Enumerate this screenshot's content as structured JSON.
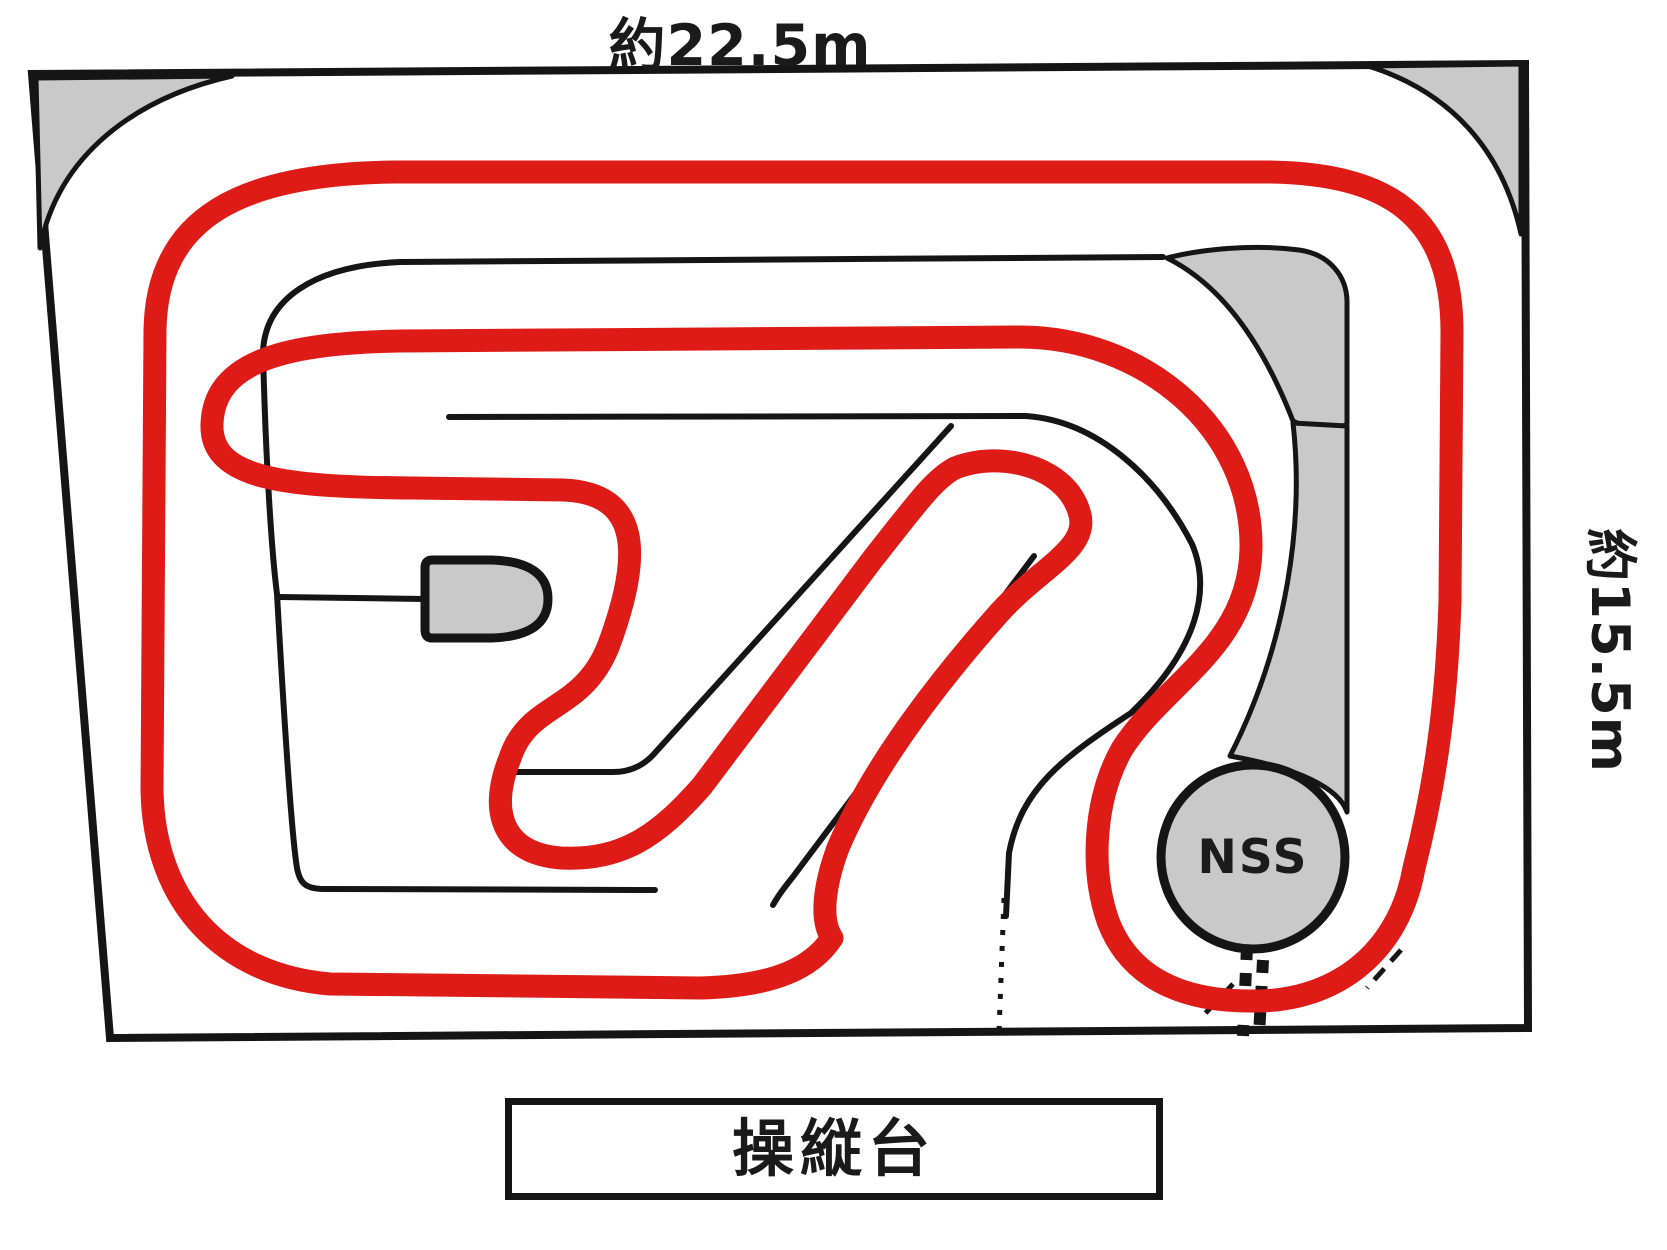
{
  "diagram": {
    "labels": {
      "course_width": "約22.5m",
      "course_height": "約15.5m",
      "control_platform": "操縦台",
      "nss_marker": "NSS"
    },
    "colors": {
      "driving_line": "#de1b17",
      "off_track_area": "#c9c9c9",
      "wall_line": "#151515",
      "track_surface": "#ffffff"
    }
  }
}
